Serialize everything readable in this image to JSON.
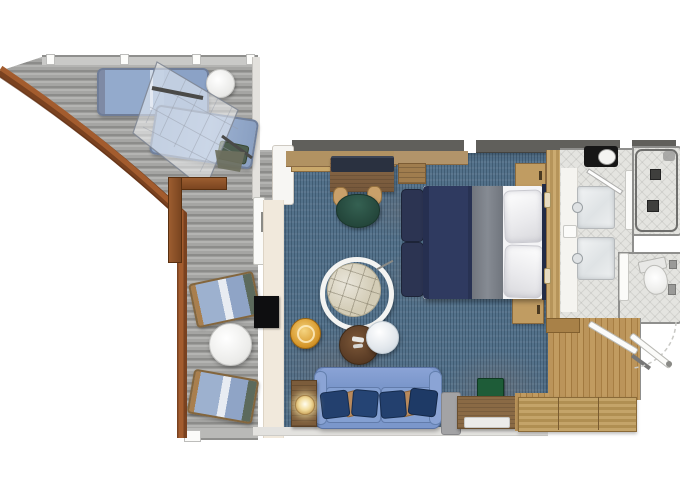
{
  "plan": {
    "title": "Ship suite floor plan with wrap-around balcony",
    "type": "floor-plan"
  },
  "rooms": {
    "balcony": {
      "label": "Wrap-around balcony",
      "features": [
        "curved teak railing",
        "grey plank decking",
        "sun lounger",
        "day bed with canopy net",
        "white round table",
        "two deck chairs",
        "round deck table",
        "balcony partition door"
      ]
    },
    "bedroom_living": {
      "label": "Bedroom and living area",
      "features": [
        "bed with navy duvet, grey runner and two pillows",
        "two foot benches",
        "headboard",
        "two nightstands",
        "desk with monitor and green chair",
        "amenity tray",
        "overbed shelf",
        "swivel tub chair",
        "gold drum stool",
        "round coffee table",
        "round mirror side table",
        "blue sofa with navy and tan cushions",
        "lamp side table",
        "wall-mounted TV",
        "grey luggage bench",
        "green mini fridge",
        "wood console with tray",
        "sliding balcony door"
      ]
    },
    "bathroom": {
      "label": "Bathroom",
      "features": [
        "dark vanity with basin",
        "double marble sinks with faucets",
        "towel stack",
        "glass shower door"
      ]
    },
    "shower": {
      "label": "Shower room",
      "features": [
        "tiled enclosure",
        "two floor drains",
        "shower fixture"
      ]
    },
    "wc": {
      "label": "Toilet room",
      "features": [
        "toilet with tank",
        "wall fixtures",
        "privacy door"
      ]
    },
    "entry": {
      "label": "Entry hall",
      "features": [
        "wood plank floor",
        "entrance door with swing arc",
        "bathroom door leaf",
        "wardrobe row",
        "threshold"
      ]
    }
  },
  "colors": {
    "carpet_blue": "#53718a",
    "deck_grey": "#9d9d9b",
    "railing_teak": "#8a4c28",
    "sofa_blue": "#7b97cb",
    "pillow_navy": "#23406e",
    "pillow_tan": "#b98a5c",
    "bed_duvet_navy": "#2f3a60",
    "bed_runner_grey": "#7e838b",
    "linen_white": "#f4f4f6",
    "wood_floor": "#b08a50",
    "tile_grey": "#e4e4e0",
    "minibar_green": "#1e5c38",
    "stool_gold": "#d89a2e",
    "chair_green": "#2c5246"
  }
}
